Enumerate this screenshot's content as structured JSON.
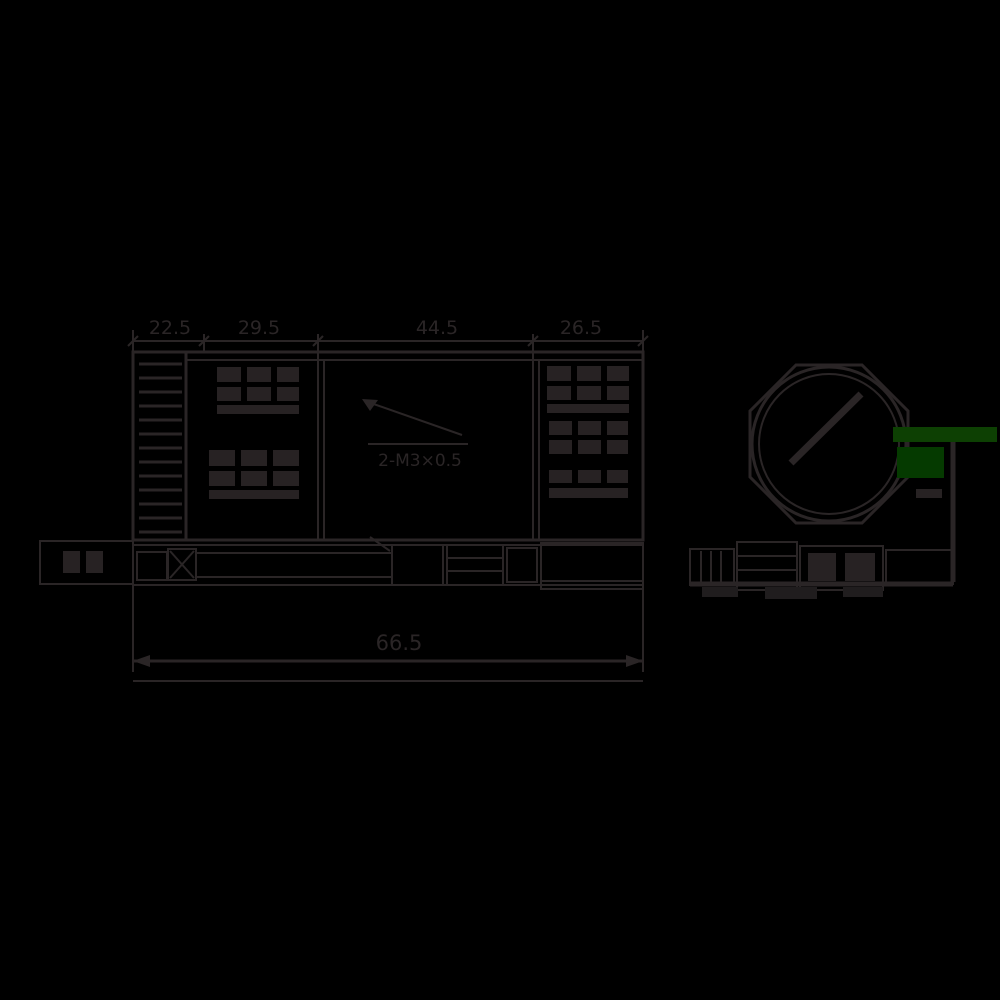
{
  "meta": {
    "drawing_type": "technical-dimension-drawing",
    "background_color": "#000000",
    "line_color": "#2a2526",
    "accent_green_bar": "#0d4003",
    "accent_green_block": "#053a00"
  },
  "front_view": {
    "top_dimensions": [
      "22.5",
      "29.5",
      "44.5",
      "26.5"
    ],
    "bottom_dimension": "66.5",
    "leader_annotation": "2-M3×0.5"
  },
  "figures": {
    "left": "device-front-and-bottom-view",
    "right": "knob-face-and-side-view"
  }
}
